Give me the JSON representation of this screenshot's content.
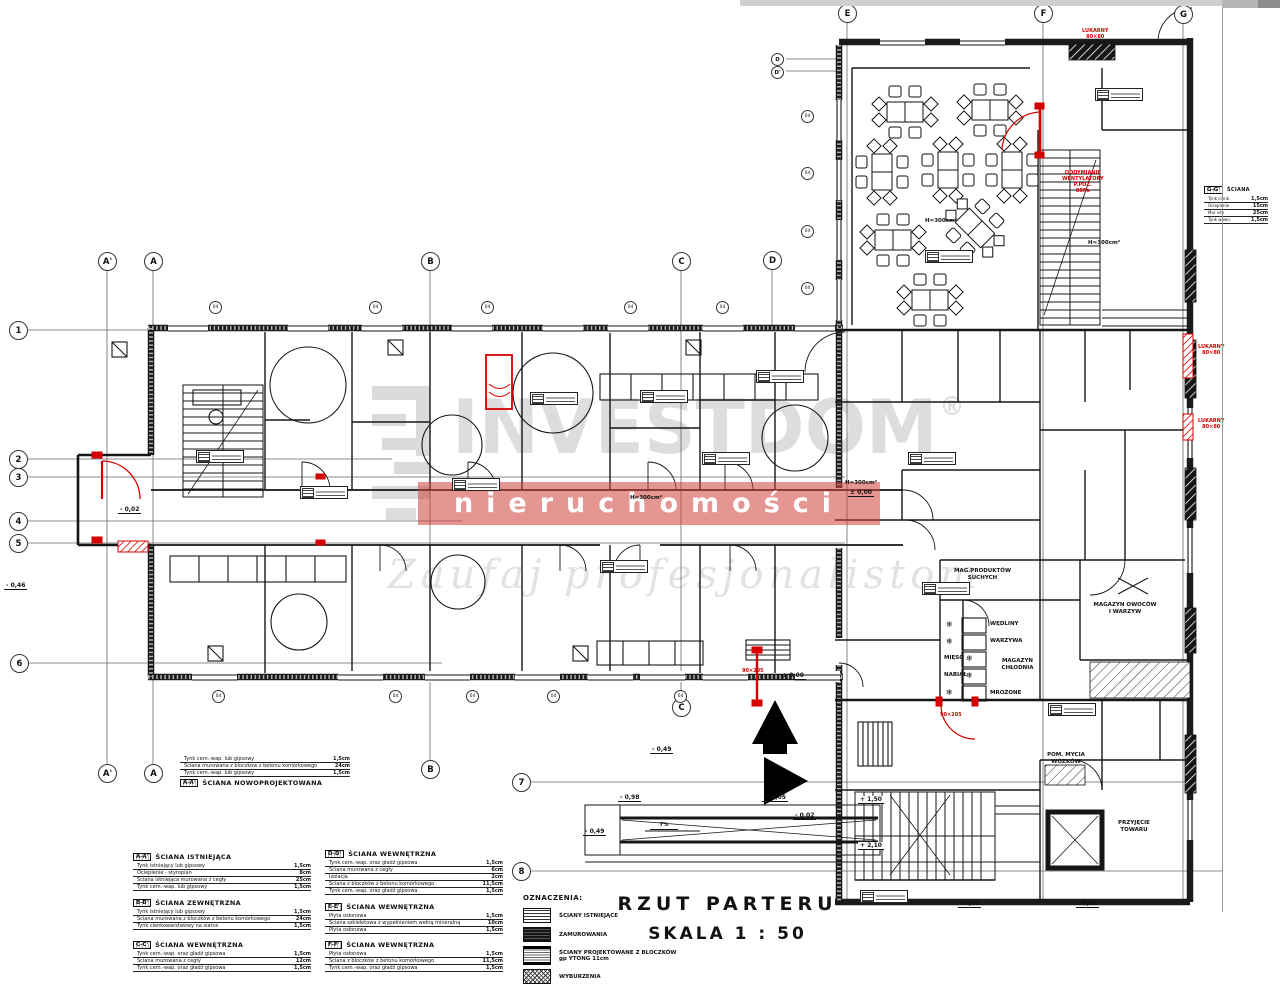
{
  "drawing": {
    "title": "RZUT PARTERU",
    "scale": "SKALA 1 : 50"
  },
  "legend": {
    "heading": "OZNACZENIA:",
    "items": [
      {
        "key": "istniejace",
        "label": "ŚCIANY ISTNIEJĄCE"
      },
      {
        "key": "zamurowania",
        "label": "ZAMUROWANIA"
      },
      {
        "key": "projektowane",
        "label": "ŚCIANY PROJEKTOWANE Z BLOCZKÓW gp YTONG 11cm"
      },
      {
        "key": "wyburzenia",
        "label": "WYBURZENIA"
      }
    ]
  },
  "watermark": {
    "brand": "INVESTDOM",
    "reg": "®",
    "band": "nieruchomości",
    "tagline": "Zaufaj profesjonalistom"
  },
  "grid": {
    "top_letters": [
      "A'",
      "A",
      "B",
      "C",
      "D"
    ],
    "right_letters": [
      "E",
      "F",
      "G"
    ],
    "bottom_letters": [
      "A'",
      "A",
      "B",
      "C"
    ],
    "numbers": [
      "1",
      "2",
      "3",
      "4",
      "5",
      "6",
      "7",
      "8"
    ],
    "small_axes": [
      "D",
      "D'"
    ],
    "window_marker": "04"
  },
  "rooms": {
    "dry_storage": [
      "MAG.PRODUKTÓW",
      "SUCHYCH"
    ],
    "cold_storage": [
      "MAGAZYN",
      "CHŁODNIA"
    ],
    "fridges": [
      "WĘDLINY",
      "WARZYWA",
      "MIĘSO",
      "NABIAŁ",
      "MROŻONE"
    ],
    "fruit_storage": [
      "MAGAZYN OWOCÓW",
      "I WARZYW"
    ],
    "cart_wash": [
      "POM. MYCIA",
      "WÓZKÓW"
    ],
    "goods_in": [
      "PRZYJĘCIE",
      "TOWARU"
    ],
    "hall_height": "H=300cm²",
    "ramp_slope": "7%"
  },
  "annotations": {
    "elevations": [
      {
        "t": "± 0,00"
      },
      {
        "t": "± 0,00"
      },
      {
        "t": "- 0,02"
      },
      {
        "t": "- 0,46"
      },
      {
        "t": "- 0,49"
      },
      {
        "t": "- 0,98"
      },
      {
        "t": "+ 0,05"
      },
      {
        "t": "- 0,02"
      },
      {
        "t": "- 0,49"
      },
      {
        "t": "+ 1,50"
      },
      {
        "t": "+ 2,10"
      },
      {
        "t": "- 0,05"
      },
      {
        "t": "- 0,02"
      }
    ],
    "red_notes": {
      "top": [
        "LUKARNY",
        "80×80"
      ],
      "stair": [
        "ODDYMIANIE",
        "WENTYLATORY",
        "P.POŻ.",
        "80Pa"
      ],
      "side1": [
        "LUKARNY",
        "80×80"
      ],
      "side2": [
        "LUKARNY",
        "80×80"
      ],
      "door": "90×205"
    }
  },
  "wall_tables": [
    {
      "code": "A-A'",
      "title": "ŚCIANA ISTNIEJĄCA",
      "rows": [
        [
          "Tynk istniejący lub gipsowy",
          "1,5cm"
        ],
        [
          "Ocieplenie - styropian",
          "8cm"
        ],
        [
          "Ściana istniejąca murowana z cegły",
          "25cm"
        ],
        [
          "Tynk cem.-wap. lub gipsowy",
          "1,5cm"
        ]
      ]
    },
    {
      "code": "B-B'",
      "title": "ŚCIANA ZEWNĘTRZNA",
      "rows": [
        [
          "Tynk istniejący lub gipsowy",
          "1,5cm"
        ],
        [
          "Ściana murowana z bloczków z betonu komórkowego",
          "24cm"
        ],
        [
          "Tynk cienkowarstwowy na siatce",
          "1,5cm"
        ]
      ]
    },
    {
      "code": "C-C'",
      "title": "ŚCIANA WEWNĘTRZNA",
      "rows": [
        [
          "Tynk cem.-wap. oraz gładź gipsowa",
          "1,5cm"
        ],
        [
          "Ściana murowana z cegły",
          "12cm"
        ],
        [
          "Tynk cem.-wap. oraz gładź gipsowa",
          "1,5cm"
        ]
      ]
    },
    {
      "code": "D-D'",
      "title": "ŚCIANA WEWNĘTRZNA",
      "rows": [
        [
          "Tynk cem.-wap. oraz gładź gipsowa",
          "1,5cm"
        ],
        [
          "Ściana murowana z cegły",
          "6cm"
        ],
        [
          "Izolacja",
          "2cm"
        ],
        [
          "Ściana z bloczków z betonu komórkowego",
          "11,5cm"
        ],
        [
          "Tynk cem.-wap. oraz gładź gipsowa",
          "1,5cm"
        ]
      ]
    },
    {
      "code": "E-E'",
      "title": "ŚCIANA WEWNĘTRZNA",
      "rows": [
        [
          "Płyta osłonowa",
          "1,5cm"
        ],
        [
          "Ściana szkieletowa z wypełnieniem wełną mineralną",
          "10cm"
        ],
        [
          "Płyta osłonowa",
          "1,5cm"
        ]
      ]
    },
    {
      "code": "F-F'",
      "title": "ŚCIANA WEWNĘTRZNA",
      "rows": [
        [
          "Płyta osłonowa",
          "1,5cm"
        ],
        [
          "Ściana z bloczków z betonu komórkowego",
          "11,5cm"
        ],
        [
          "Tynk cem.-wap. oraz gładź gipsowa",
          "1,5cm"
        ]
      ]
    },
    {
      "code": "A-A'",
      "title": "ŚCIANA NOWOPROJEKTOWANA",
      "rows": [
        [
          "Tynk cem.-wap. lub gipsowy",
          "1,5cm"
        ],
        [
          "Ściana murowana z bloczków z betonu komórkowego",
          "24cm"
        ],
        [
          "Tynk cem.-wap. lub gipsowy",
          "1,5cm"
        ]
      ]
    },
    {
      "code": "G-G'",
      "title": "ŚCIANA",
      "rows": [
        [
          "Tynk cienk.",
          "1,5cm"
        ],
        [
          "Ocieplenie",
          "15cm"
        ],
        [
          "Mur istn.",
          "25cm"
        ],
        [
          "Tynk wewn.",
          "1,5cm"
        ]
      ]
    }
  ]
}
